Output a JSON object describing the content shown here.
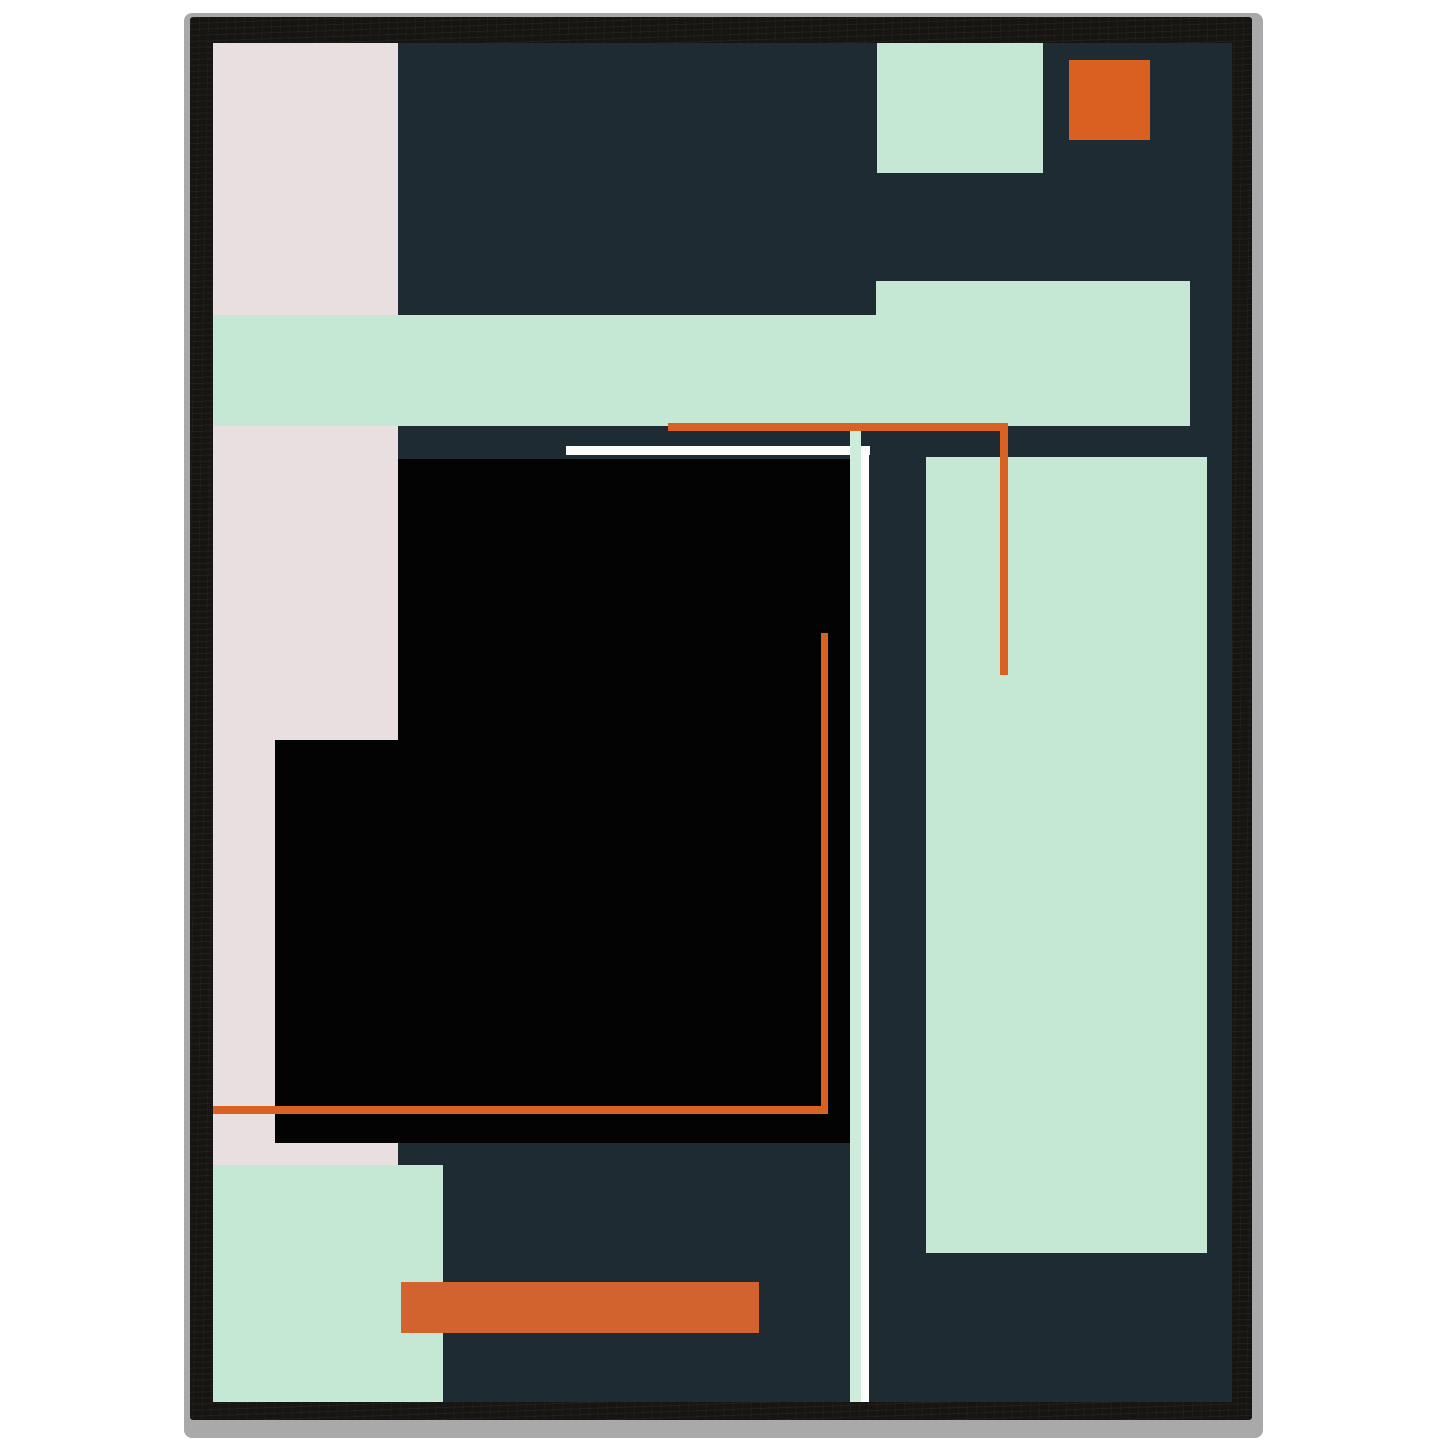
{
  "scene": {
    "background": "#ffffff",
    "frame_edge": {
      "x": 184,
      "y": 13,
      "w": 1079,
      "h": 1425,
      "color": "#a9a9a9"
    },
    "frame_wood": {
      "x": 190,
      "y": 17,
      "w": 1062,
      "h": 1403,
      "color": "#161512"
    },
    "art_area": {
      "x": 213,
      "y": 43,
      "w": 1019,
      "h": 1359,
      "color": "#1e2b33"
    }
  },
  "palette": {
    "canvas_navy": "#1e2b33",
    "blush_pink": "#e9dfe1",
    "mint_green": "#c4e8d3",
    "pale_mint_line": "#cdecdc",
    "accent_orange": "#d96122",
    "deep_orange_bar": "#d2622e",
    "pure_black": "#030303",
    "line_white": "#fbfefc",
    "frame_black": "#161512",
    "edge_gray": "#a9a9a9"
  },
  "shapes": [
    {
      "name": "pink-column",
      "x": 0,
      "y": 0,
      "w": 185,
      "h": 1122,
      "color": "#e9dfe1"
    },
    {
      "name": "mint-square-top",
      "x": 664,
      "y": 0,
      "w": 166,
      "h": 130,
      "color": "#c4e8d3"
    },
    {
      "name": "orange-square-top-right",
      "x": 856,
      "y": 17,
      "w": 81,
      "h": 80,
      "color": "#da6021"
    },
    {
      "name": "mint-block-upper-right",
      "x": 663,
      "y": 238,
      "w": 314,
      "h": 145,
      "color": "#c4e8d3"
    },
    {
      "name": "mint-band-horizontal",
      "x": 0,
      "y": 272,
      "w": 977,
      "h": 111,
      "color": "#c4e8d3"
    },
    {
      "name": "mint-rect-right-tall",
      "x": 713,
      "y": 414,
      "w": 281,
      "h": 796,
      "color": "#c4e8d3"
    },
    {
      "name": "black-square-main",
      "x": 185,
      "y": 416,
      "w": 452,
      "h": 684,
      "color": "#030303"
    },
    {
      "name": "black-square-left-extension",
      "x": 62,
      "y": 697,
      "w": 123,
      "h": 403,
      "color": "#030303"
    },
    {
      "name": "white-line-horizontal",
      "x": 353,
      "y": 403,
      "w": 304,
      "h": 9,
      "color": "#fbfefc"
    },
    {
      "name": "mint-line-vertical",
      "x": 637,
      "y": 381,
      "w": 11,
      "h": 978,
      "color": "#cdecdc"
    },
    {
      "name": "white-line-vertical",
      "x": 648,
      "y": 403,
      "w": 8,
      "h": 956,
      "color": "#fbfefc"
    },
    {
      "name": "orange-line-top-horizontal",
      "x": 455,
      "y": 380,
      "w": 340,
      "h": 8,
      "color": "#d96122"
    },
    {
      "name": "orange-line-top-vertical",
      "x": 787,
      "y": 380,
      "w": 8,
      "h": 252,
      "color": "#d96122"
    },
    {
      "name": "orange-line-inner-vertical",
      "x": 608,
      "y": 590,
      "w": 7,
      "h": 481,
      "color": "#d96122"
    },
    {
      "name": "orange-line-bottom-horizontal",
      "x": 0,
      "y": 1063,
      "w": 615,
      "h": 8,
      "color": "#d96122"
    },
    {
      "name": "mint-block-bottom-left",
      "x": 0,
      "y": 1122,
      "w": 230,
      "h": 237,
      "color": "#c4e8d3"
    },
    {
      "name": "orange-bar-bottom",
      "x": 188,
      "y": 1239,
      "w": 358,
      "h": 51,
      "color": "#d2622e"
    }
  ]
}
